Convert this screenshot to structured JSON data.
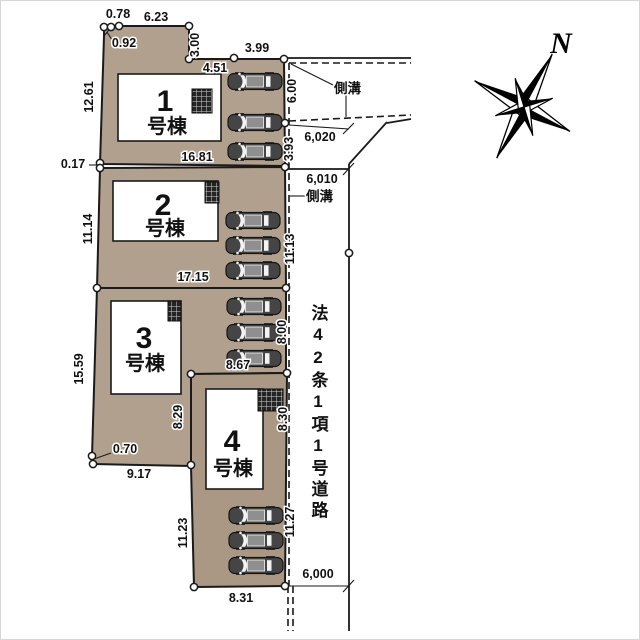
{
  "title": "分譲地区画図",
  "compass": {
    "north_label": "N"
  },
  "road": {
    "name": "法42条1項1号道路"
  },
  "gutters": {
    "top_label": "側溝",
    "side_label": "側溝"
  },
  "buildings": [
    {
      "number": "1",
      "suffix": "号棟"
    },
    {
      "number": "2",
      "suffix": "号棟"
    },
    {
      "number": "3",
      "suffix": "号棟"
    },
    {
      "number": "4",
      "suffix": "号棟"
    }
  ],
  "colors": {
    "lot_fill": "#b2a08e",
    "line": "#1a1a1a",
    "building_fill": "#ffffff",
    "car_body": "#454545"
  },
  "dimensions": [
    {
      "text": "0.78",
      "x": 117,
      "y": 17,
      "rot": 0
    },
    {
      "text": "6.23",
      "x": 155,
      "y": 20,
      "rot": 0
    },
    {
      "text": "0.92",
      "x": 123,
      "y": 46,
      "rot": 0
    },
    {
      "text": "3.00",
      "x": 198,
      "y": 44,
      "rot": -90
    },
    {
      "text": "3.99",
      "x": 256,
      "y": 51,
      "rot": 0
    },
    {
      "text": "4.51",
      "x": 214,
      "y": 71,
      "rot": 0
    },
    {
      "text": "12.61",
      "x": 92,
      "y": 96,
      "rot": -90
    },
    {
      "text": "16.81",
      "x": 196,
      "y": 160,
      "rot": 0
    },
    {
      "text": "0.17",
      "x": 72,
      "y": 167,
      "rot": 0
    },
    {
      "text": "11.14",
      "x": 91,
      "y": 228,
      "rot": -90
    },
    {
      "text": "17.15",
      "x": 192,
      "y": 280,
      "rot": 0
    },
    {
      "text": "15.59",
      "x": 82,
      "y": 368,
      "rot": -90
    },
    {
      "text": "8.67",
      "x": 237,
      "y": 368,
      "rot": 0
    },
    {
      "text": "8.29",
      "x": 181,
      "y": 416,
      "rot": -90
    },
    {
      "text": "0.70",
      "x": 124,
      "y": 452,
      "rot": 0
    },
    {
      "text": "9.17",
      "x": 138,
      "y": 477,
      "rot": 0
    },
    {
      "text": "11.23",
      "x": 186,
      "y": 532,
      "rot": -90
    },
    {
      "text": "8.31",
      "x": 240,
      "y": 601,
      "rot": 0
    },
    {
      "text": "6.00",
      "x": 295,
      "y": 90,
      "rot": -90
    },
    {
      "text": "3.93",
      "x": 292,
      "y": 148,
      "rot": -90
    },
    {
      "text": "11.13",
      "x": 293,
      "y": 248,
      "rot": -90
    },
    {
      "text": "8.00",
      "x": 285,
      "y": 331,
      "rot": -90
    },
    {
      "text": "8.30",
      "x": 286,
      "y": 418,
      "rot": -90
    },
    {
      "text": "11.27",
      "x": 293,
      "y": 521,
      "rot": -90
    },
    {
      "text": "6,020",
      "x": 319,
      "y": 140,
      "rot": 0
    },
    {
      "text": "6,010",
      "x": 321,
      "y": 182,
      "rot": 0
    },
    {
      "text": "6,000",
      "x": 317,
      "y": 577,
      "rot": 0
    }
  ]
}
